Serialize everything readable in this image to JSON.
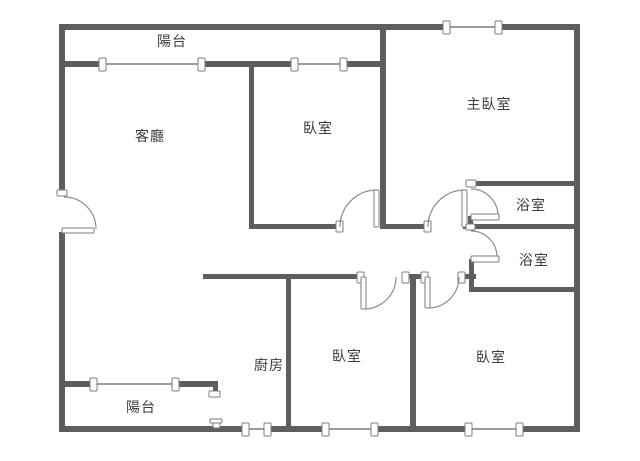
{
  "rooms": {
    "balcony_top": {
      "label": "陽台"
    },
    "living_room": {
      "label": "客廳"
    },
    "bedroom_top": {
      "label": "臥室"
    },
    "master_bedroom": {
      "label": "主臥室"
    },
    "bathroom_upper": {
      "label": "浴室"
    },
    "bathroom_lower": {
      "label": "浴室"
    },
    "kitchen": {
      "label": "廚房"
    },
    "bedroom_bottom_middle": {
      "label": "臥室"
    },
    "bedroom_bottom_right": {
      "label": "臥室"
    },
    "balcony_bottom": {
      "label": "陽台"
    }
  },
  "colors": {
    "wall": "#5e5e5e",
    "window_line": "#9b9b9b",
    "door_arc": "#8d8d8d",
    "cap_border": "#7d7d7d",
    "label_text": "#3c3c3c",
    "background": "#ffffff"
  }
}
